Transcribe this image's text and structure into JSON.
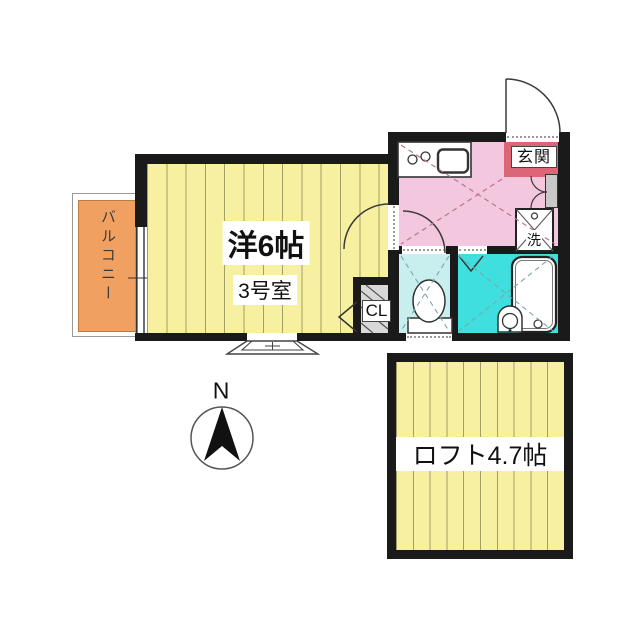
{
  "floorplan": {
    "main_room": {
      "size_label": "洋6帖",
      "room_number": "3号室"
    },
    "balcony_label": "バルコニー",
    "entrance_label": "玄関",
    "washer_label": "洗",
    "closet_label": "CL",
    "loft_label": "ロフト4.7帖",
    "compass_north_label": "N",
    "colors": {
      "room_floor_yellow": "#f6f0a0",
      "hall_pink": "#f3c7dd",
      "entrance_accent_red": "#dc6677",
      "toilet_light_cyan": "#c8efee",
      "bath_teal": "#3fdfdf",
      "balcony_orange": "#f0a161",
      "wall_black": "#1a1a1a",
      "closet_gray": "#d8d8d8"
    }
  }
}
